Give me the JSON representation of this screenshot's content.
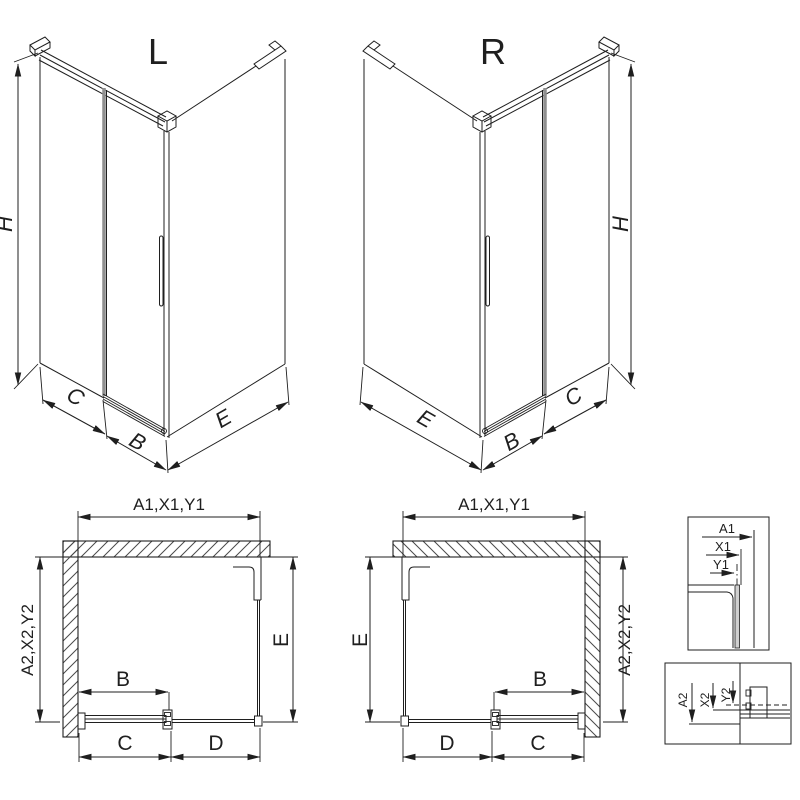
{
  "colors": {
    "line": "#1f1f1f",
    "glass_edge": "#8f8f8f",
    "hatch": "#4a4a4a",
    "background": "#ffffff"
  },
  "iso_left": {
    "variant": "L",
    "dim_height": "H",
    "dim_back_width": "C",
    "dim_door": "B",
    "dim_side": "E"
  },
  "iso_right": {
    "variant": "R",
    "dim_height": "H",
    "dim_back_width": "C",
    "dim_door": "B",
    "dim_side": "E"
  },
  "plan_left": {
    "dim_top": "A1,X1,Y1",
    "dim_wall_side": "A2,X2,Y2",
    "dim_side": "E",
    "dim_door": "B",
    "dim_fixed": "C",
    "dim_opening": "D"
  },
  "plan_right": {
    "dim_top": "A1,X1,Y1",
    "dim_wall_side": "A2,X2,Y2",
    "dim_side": "E",
    "dim_door": "B",
    "dim_fixed": "C",
    "dim_opening": "D"
  },
  "detail_top_profile": {
    "dim_a": "A1",
    "dim_x": "X1",
    "dim_y": "Y1"
  },
  "detail_bottom_rail": {
    "dim_a": "A2",
    "dim_x": "X2",
    "dim_y": "Y2"
  }
}
